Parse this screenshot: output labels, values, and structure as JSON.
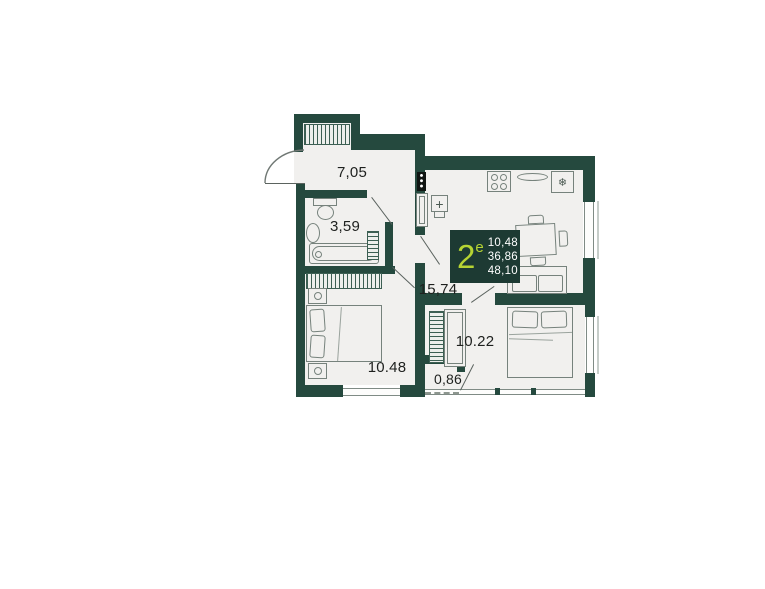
{
  "plan": {
    "badge": {
      "type_number": "2",
      "type_suffix": "е",
      "areas": [
        "10,48",
        "36,86",
        "48,10"
      ]
    },
    "rooms": {
      "hallway": {
        "area": "7,05"
      },
      "bathroom": {
        "area": "3,59"
      },
      "kitchen_living": {
        "area": "15,74"
      },
      "bedroom_1": {
        "area": "10.48"
      },
      "closet": {
        "area": "0,86"
      },
      "bedroom_2": {
        "area": "10.22"
      }
    },
    "icons": {
      "fridge_snowflake": "❄",
      "sink_cross": "+"
    },
    "colors": {
      "wall": "#25493e",
      "floor": "#f1f0ee",
      "badge_bg": "#1d3a33",
      "accent_lime": "#b6d433",
      "label_text": "#1e201e"
    }
  }
}
